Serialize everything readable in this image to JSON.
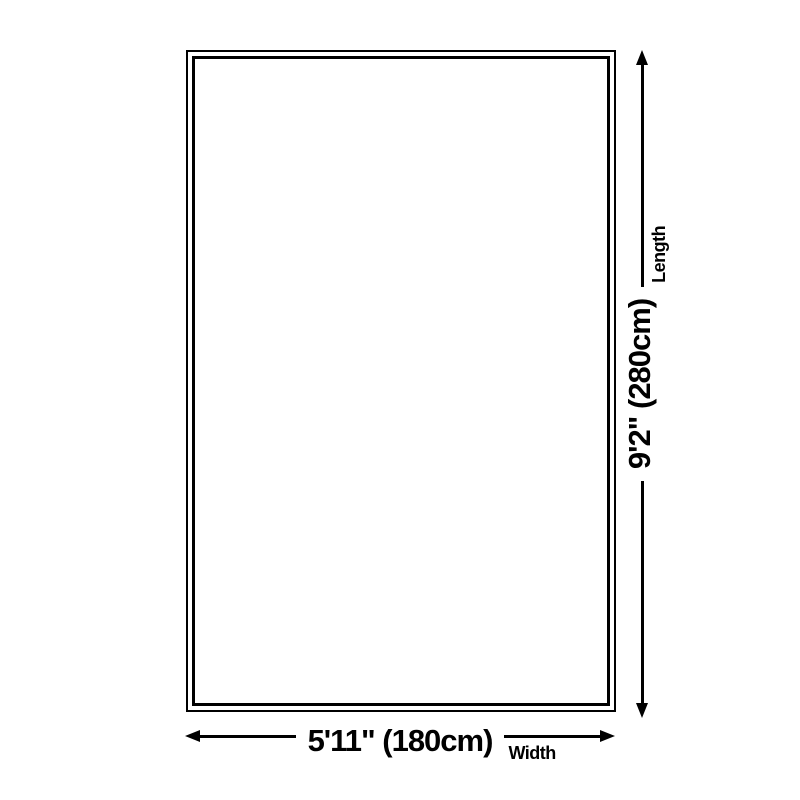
{
  "diagram": {
    "colors": {
      "line": "#000000",
      "background": "#ffffff"
    },
    "width_dim": {
      "value": "5'11\" (180cm)",
      "label": "Width"
    },
    "length_dim": {
      "value": "9'2\" (280cm)",
      "label": "Length"
    }
  }
}
